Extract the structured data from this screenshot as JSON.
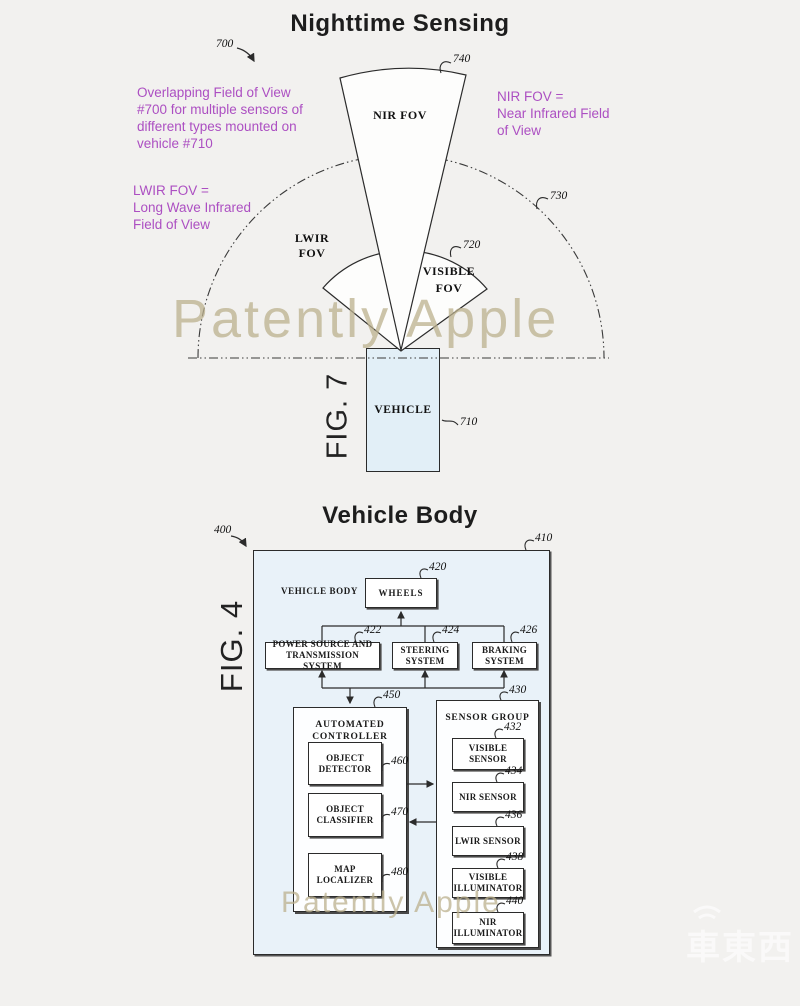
{
  "colors": {
    "background": "#f2f1ef",
    "annotation_purple": "#ac4fc2",
    "fig4_outer_fill": "#e9f2f9",
    "vehicle_fill": "#e2eff7",
    "watermark_tan": "#bbb08e",
    "line_ink": "#2b2b2b"
  },
  "fig7": {
    "title": "Nighttime Sensing",
    "fig_label": "FIG. 7",
    "annotation_overlap": [
      "Overlapping Field of View",
      "#700 for multiple sensors of",
      "different types mounted on",
      "vehicle #710"
    ],
    "annotation_nir": [
      "NIR FOV =",
      "Near Infrared Field",
      "of View"
    ],
    "annotation_lwir": [
      "LWIR FOV =",
      "Long Wave Infrared",
      "Field of View"
    ],
    "label_nir": "NIR FOV",
    "label_lwir": "LWIR FOV",
    "label_visible_1": "VISIBLE",
    "label_visible_2": "FOV",
    "label_vehicle": "VEHICLE",
    "refs": {
      "r700": "700",
      "r710": "710",
      "r720": "720",
      "r730": "730",
      "r740": "740"
    }
  },
  "fig4": {
    "title": "Vehicle Body",
    "fig_label": "FIG. 4",
    "label_vehicle_body": "VEHICLE BODY",
    "boxes": {
      "wheels": "WHEELS",
      "power": "POWER SOURCE AND TRANSMISSION SYSTEM",
      "steering": "STEERING SYSTEM",
      "braking": "BRAKING SYSTEM",
      "controller": "AUTOMATED CONTROLLER",
      "object_detector": "OBJECT DETECTOR",
      "object_classifier": "OBJECT CLASSIFIER",
      "map_localizer": "MAP LOCALIZER",
      "sensor_group": "SENSOR GROUP",
      "visible_sensor": "VISIBLE SENSOR",
      "nir_sensor": "NIR SENSOR",
      "lwir_sensor": "LWIR SENSOR",
      "visible_illuminator": "VISIBLE ILLUMINATOR",
      "nir_illuminator": "NIR ILLUMINATOR"
    },
    "refs": {
      "r400": "400",
      "r410": "410",
      "r420": "420",
      "r422": "422",
      "r424": "424",
      "r426": "426",
      "r430": "430",
      "r432": "432",
      "r434": "434",
      "r436": "436",
      "r438": "438",
      "r440": "440",
      "r450": "450",
      "r460": "460",
      "r470": "470",
      "r480": "480"
    }
  },
  "watermarks": {
    "patently": "Patently Apple",
    "logo_cn": "車東西"
  }
}
